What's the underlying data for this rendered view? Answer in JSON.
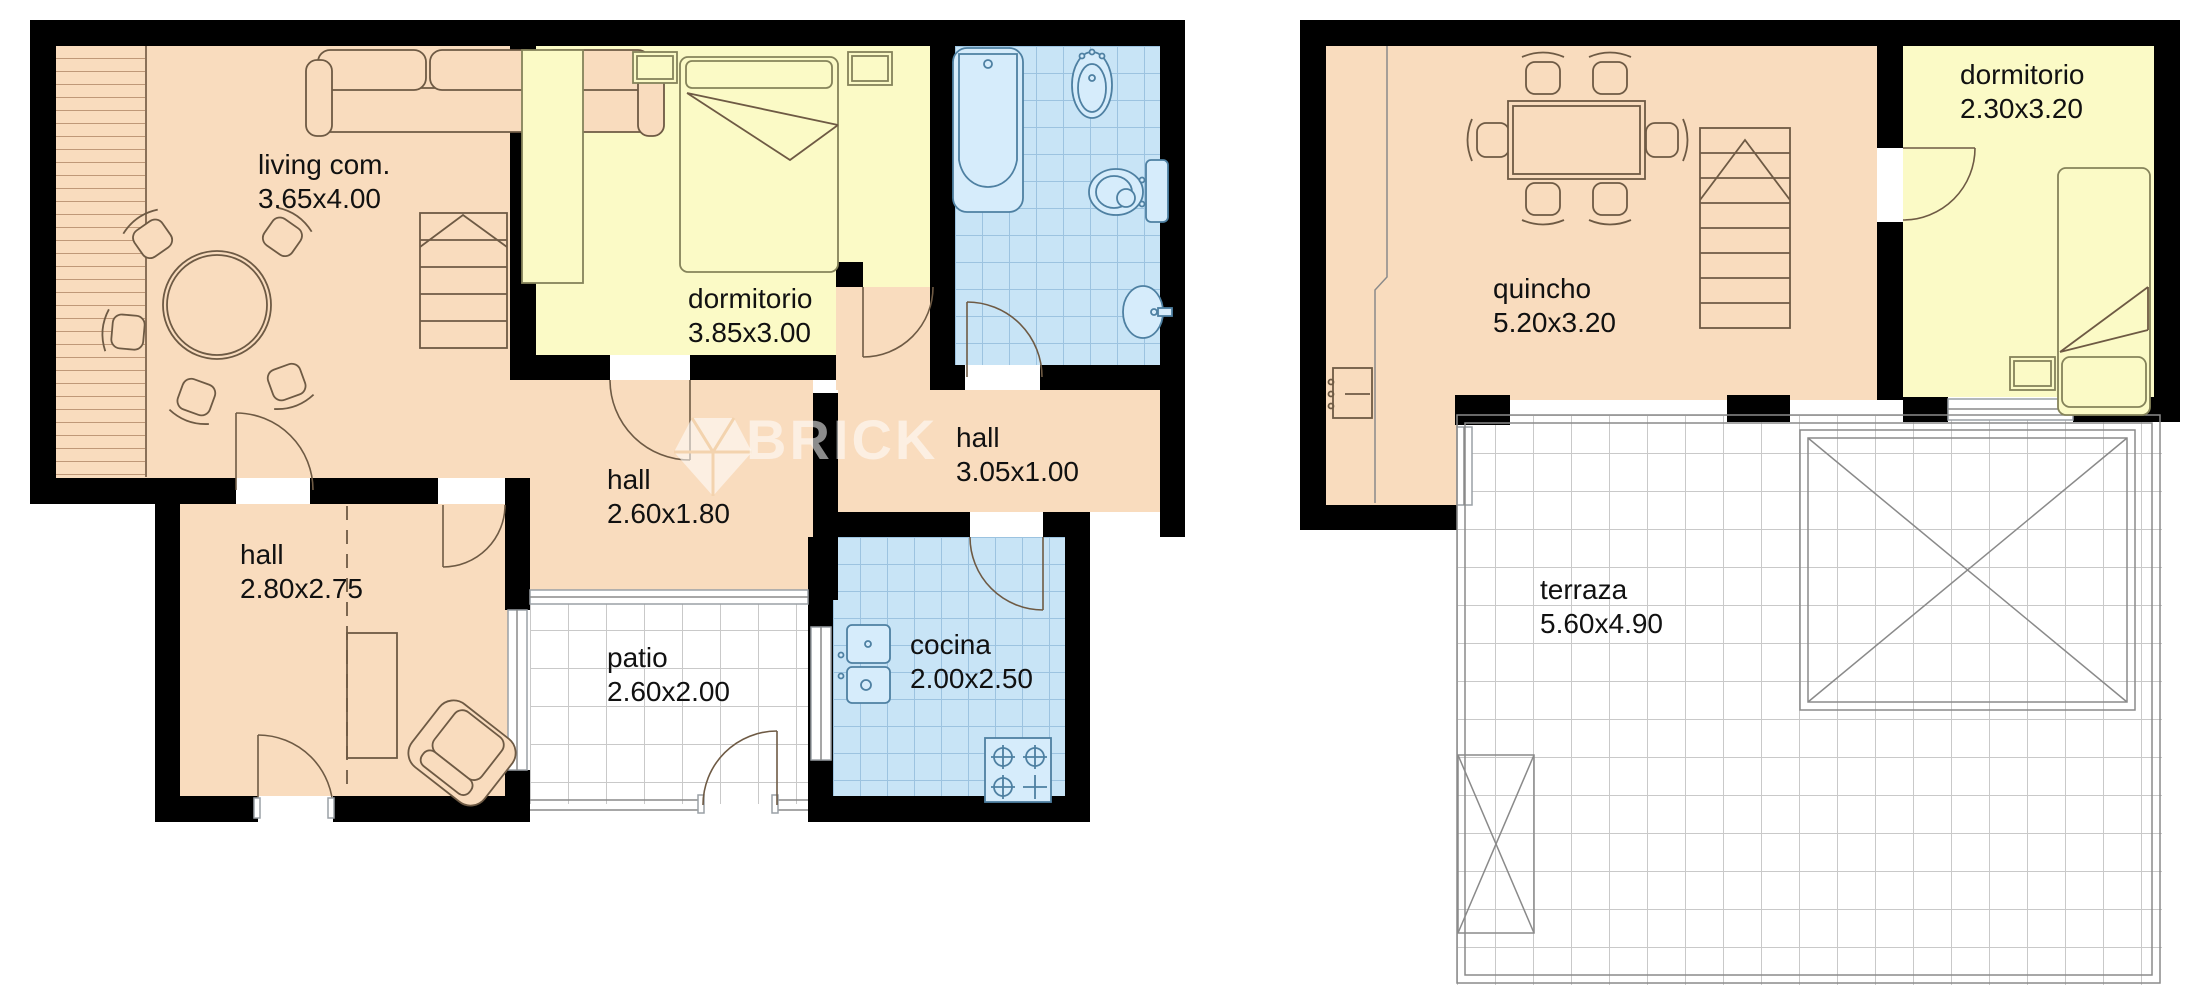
{
  "watermark": {
    "text": "BRICK"
  },
  "rooms": {
    "living": {
      "name": "living com.",
      "dims": "3.65x4.00"
    },
    "dormitorio1": {
      "name": "dormitorio",
      "dims": "3.85x3.00"
    },
    "hall_upper": {
      "name": "hall",
      "dims": "2.60x1.80"
    },
    "hall_small": {
      "name": "hall",
      "dims": "3.05x1.00"
    },
    "hall_lower": {
      "name": "hall",
      "dims": "2.80x2.75"
    },
    "patio": {
      "name": "patio",
      "dims": "2.60x2.00"
    },
    "cocina": {
      "name": "cocina",
      "dims": "2.00x2.50"
    },
    "quincho": {
      "name": "quincho",
      "dims": "5.20x3.20"
    },
    "dormitorio2": {
      "name": "dormitorio",
      "dims": "2.30x3.20"
    },
    "terraza": {
      "name": "terraza",
      "dims": "5.60x4.90"
    }
  },
  "colors": {
    "wall": "#000000",
    "room_peach": "#f9dcbe",
    "room_yellow": "#fbfac6",
    "room_blue": "#c8e4f6",
    "tile_line_blue": "#9cc3e0",
    "tile_line_gray": "#c9c9c9",
    "furniture_line": "#6e5a44",
    "fixture_line": "#4e80a2",
    "watermark_white": "#ffffff"
  }
}
